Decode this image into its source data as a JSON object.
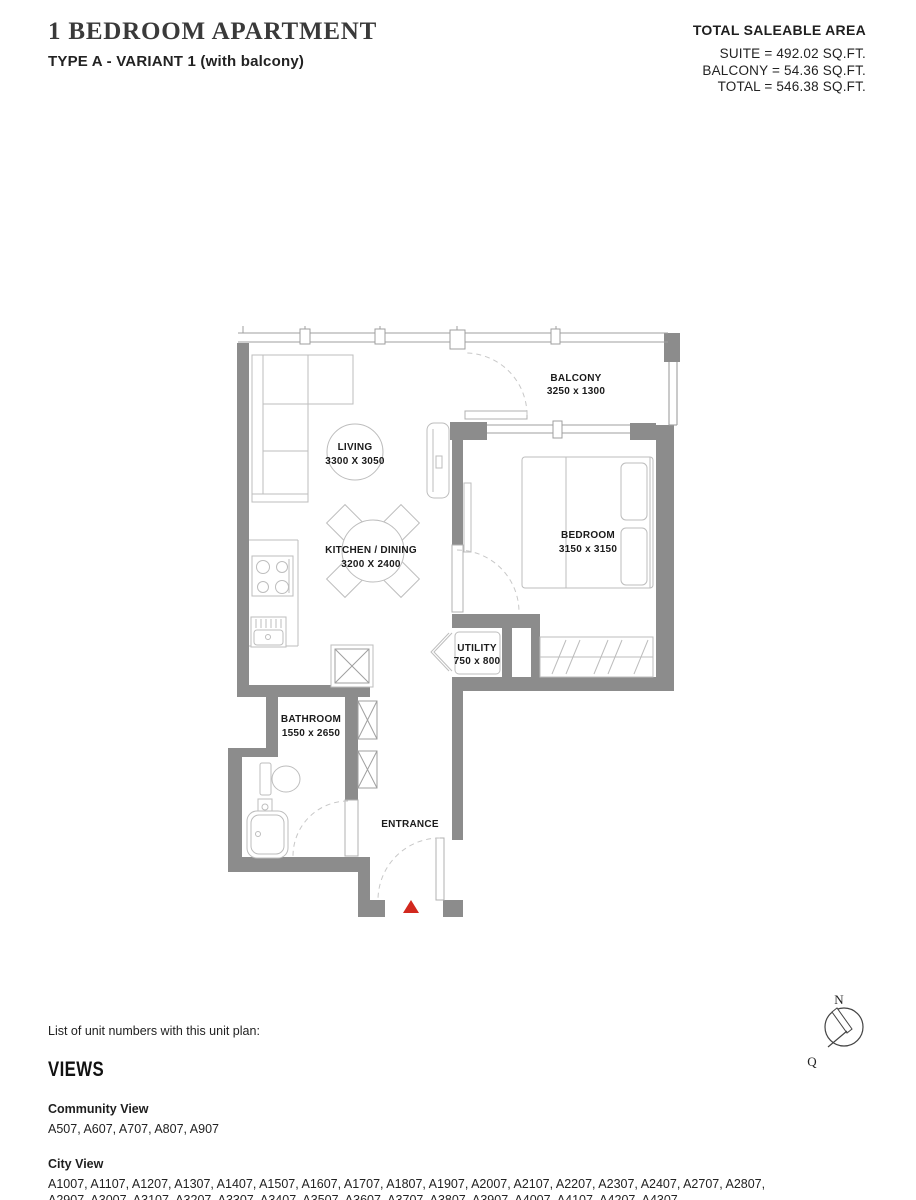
{
  "header": {
    "title": "1 BEDROOM APARTMENT",
    "subtitle": "TYPE A - VARIANT 1 (with balcony)"
  },
  "area_summary": {
    "heading": "TOTAL SALEABLE AREA",
    "suite": "SUITE = 492.02 SQ.FT.",
    "balcony": "BALCONY = 54.36 SQ.FT.",
    "total": "TOTAL = 546.38 SQ.FT."
  },
  "floor_plan": {
    "wall_color": "#8c8c8c",
    "entrance_marker_color": "#d2281e",
    "rooms": [
      {
        "name": "BALCONY",
        "dims": "3250 x 1300"
      },
      {
        "name": "LIVING",
        "dims": "3300 X 3050"
      },
      {
        "name": "KITCHEN / DINING",
        "dims": "3200 X 2400"
      },
      {
        "name": "BEDROOM",
        "dims": "3150 x 3150"
      },
      {
        "name": "UTILITY",
        "dims": "750 x 800"
      },
      {
        "name": "BATHROOM",
        "dims": "1550 x 2650"
      }
    ],
    "entrance_label": "ENTRANCE"
  },
  "unit_list": {
    "intro": "List of unit numbers with this unit plan:",
    "heading": "VIEWS",
    "community": {
      "title": "Community View",
      "line": "A507, A607, A707, A807, A907"
    },
    "city": {
      "title": "City View",
      "line1": "A1007, A1107, A1207, A1307, A1407, A1507, A1607, A1707, A1807, A1907, A2007, A2107, A2207, A2307, A2407, A2707, A2807,",
      "line2": "A2907, A3007, A3107, A3207, A3307, A3407, A3507, A3607, A3707, A3807, A3907, A4007, A4107, A4207, A4307"
    }
  },
  "compass": {
    "north": "N",
    "q": "Q"
  }
}
